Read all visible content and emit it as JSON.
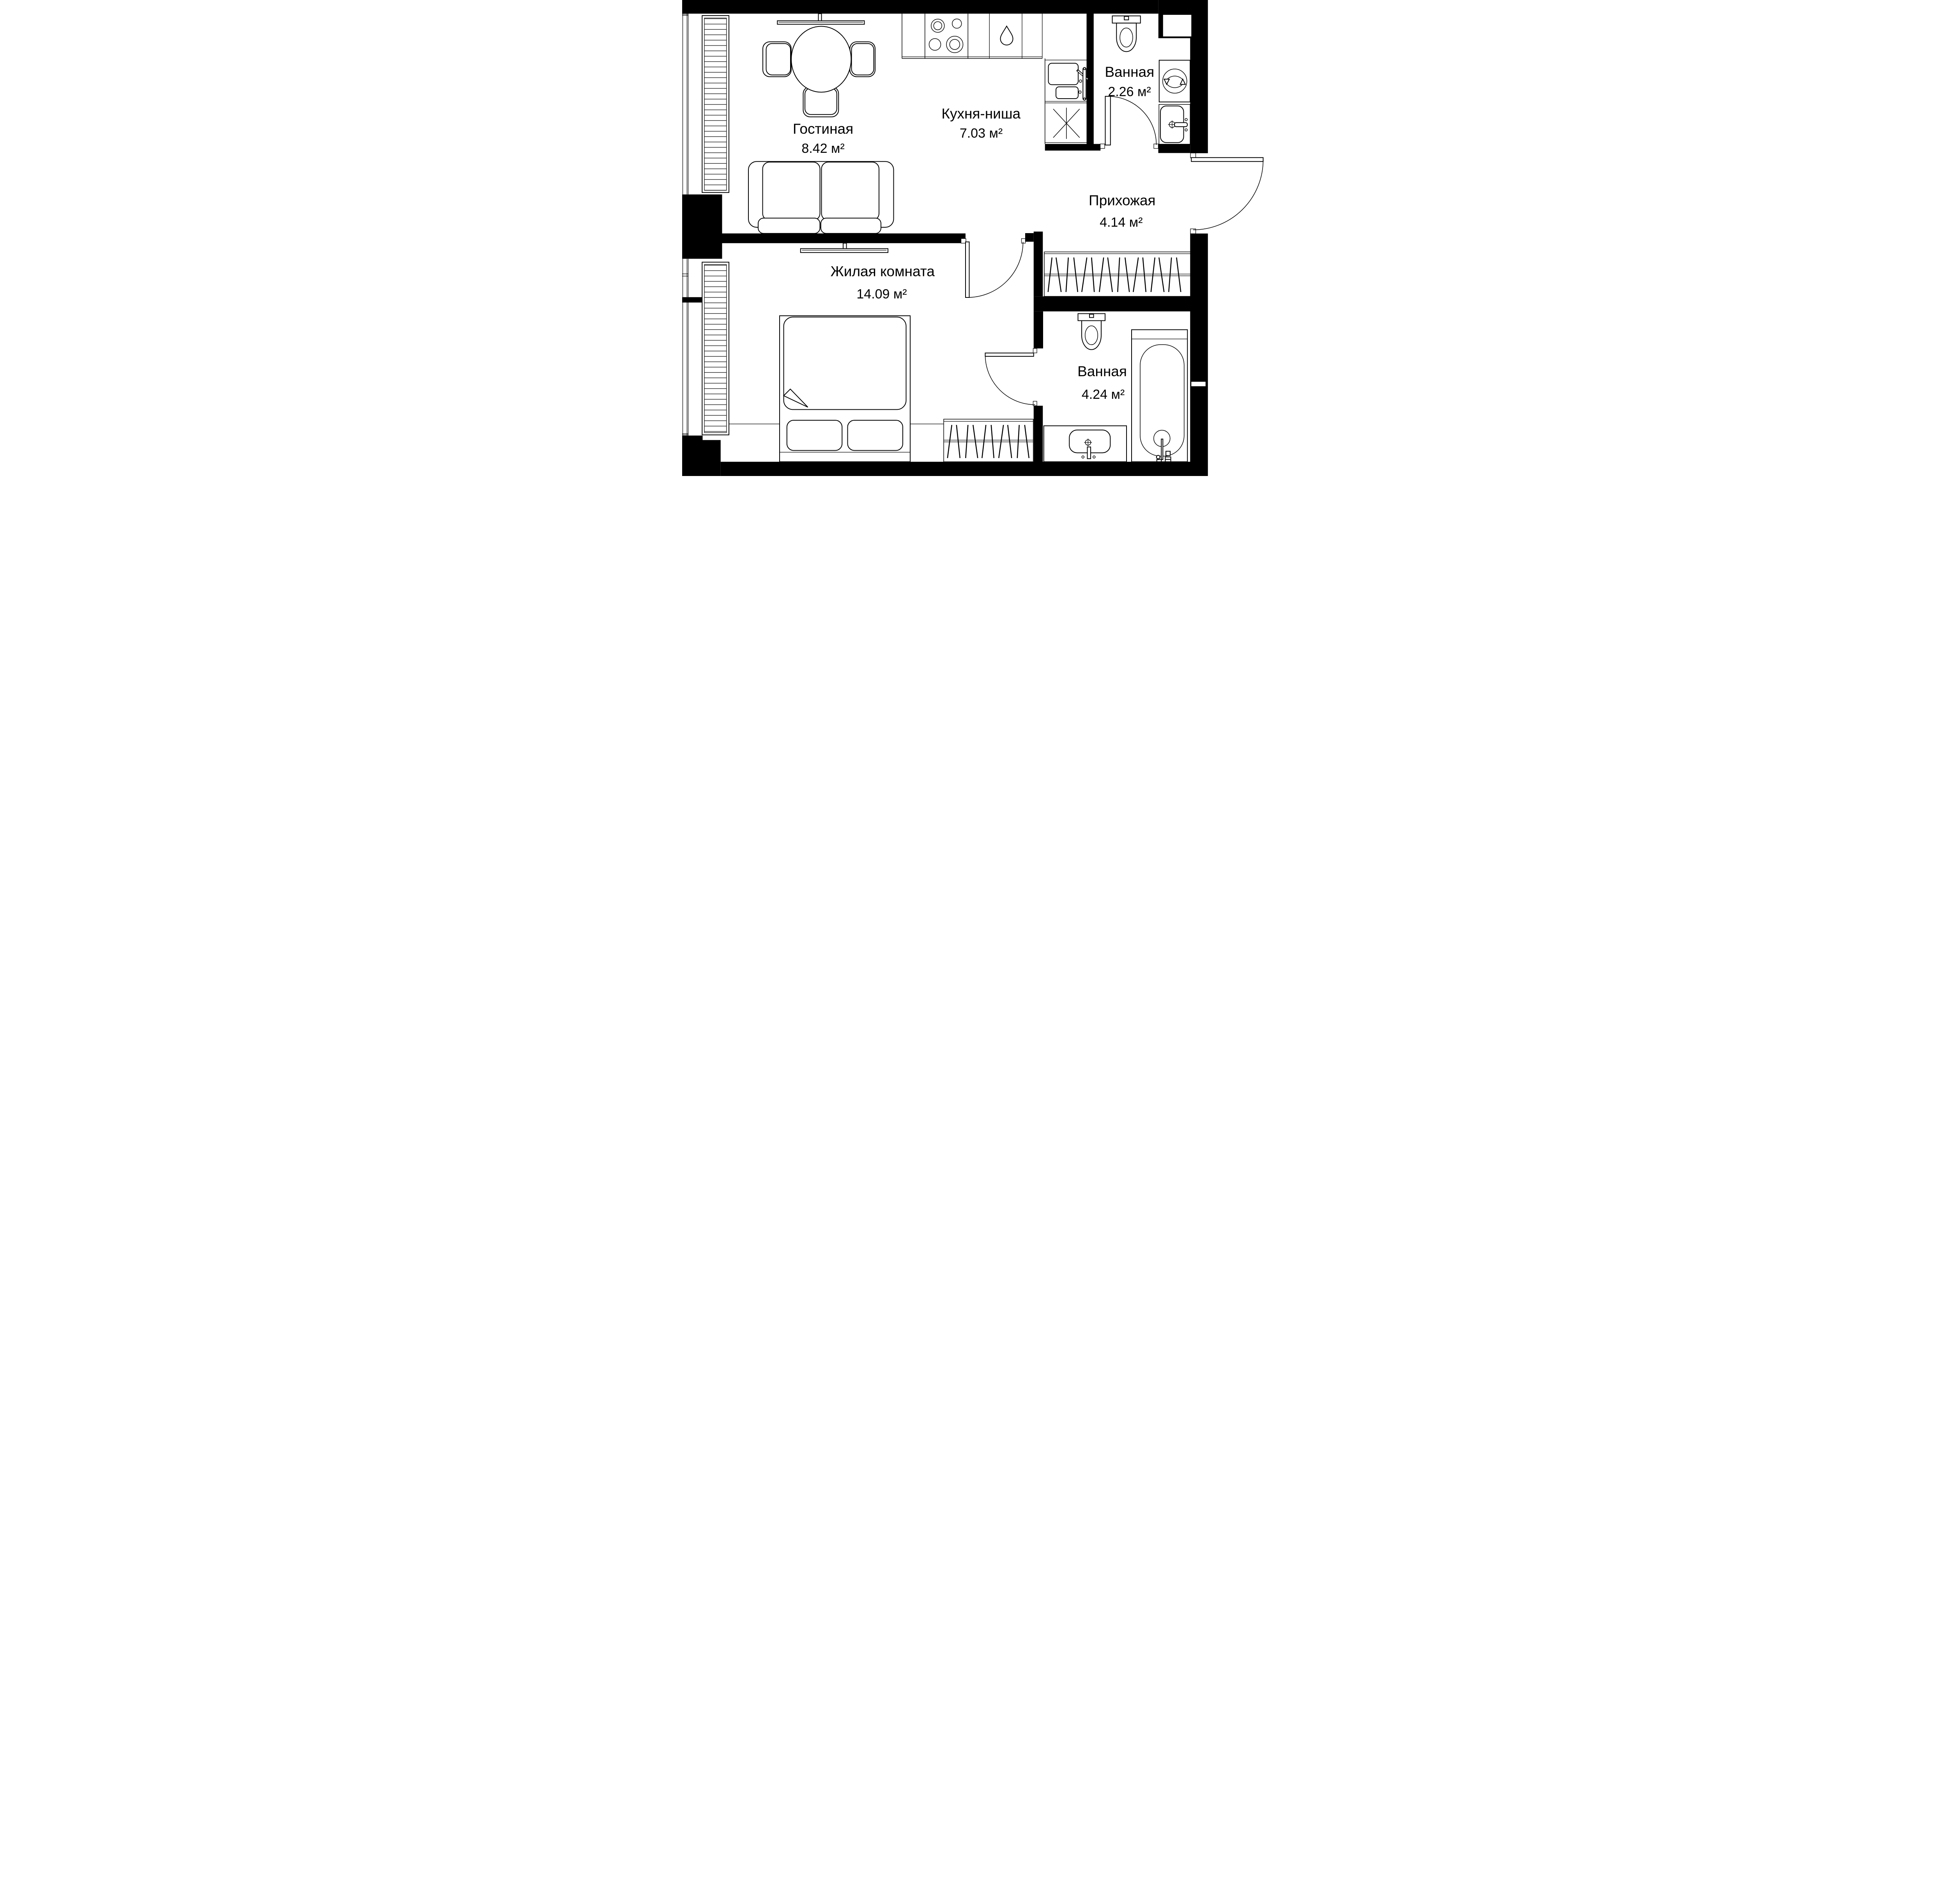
{
  "plan": {
    "type": "apartment-floor-plan",
    "background_color": "#ffffff",
    "wall_color": "#000000",
    "line_color": "#000000",
    "rooms": [
      {
        "name": "Гостиная",
        "area": "8.42 м²"
      },
      {
        "name": "Кухня-ниша",
        "area": "7.03 м²"
      },
      {
        "name": "Ванная",
        "area": "2.26 м²"
      },
      {
        "name": "Прихожая",
        "area": "4.14 м²"
      },
      {
        "name": "Жилая комната",
        "area": "14.09 м²"
      },
      {
        "name": "Ванная",
        "area": "4.24 м²"
      }
    ],
    "fixtures": [
      "dining-table-icon",
      "chair-icon",
      "tv-icon",
      "sofa-icon",
      "radiator-icon",
      "cooktop-icon",
      "water-drop-icon",
      "kitchen-sink-icon",
      "faucet-icon",
      "snowflake-appliance-icon",
      "toilet-icon",
      "washing-machine-icon",
      "bathroom-sink-icon",
      "towel-rail-icon",
      "wardrobe-hangers-icon",
      "entrance-door-icon",
      "interior-door-icon",
      "bed-icon",
      "pillow-icon",
      "bathtub-icon",
      "vanity-sink-icon",
      "window-icon"
    ]
  }
}
